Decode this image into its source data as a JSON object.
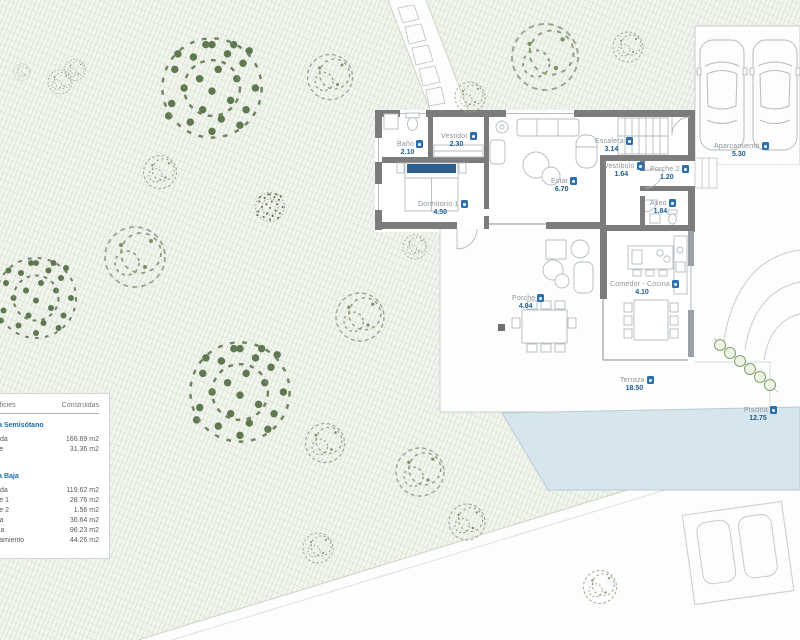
{
  "legend": {
    "header": {
      "col1": "Superficies",
      "col2": "Construidas"
    },
    "sections": [
      {
        "title": "Planta Semisótano",
        "rows": [
          {
            "label": "Vivienda",
            "value": "166.69 m2"
          },
          {
            "label": "Porche",
            "value": "31.36 m2"
          }
        ]
      },
      {
        "title": "Planta Baja",
        "rows": [
          {
            "label": "Vivienda",
            "value": "119.62 m2"
          },
          {
            "label": "Porche 1",
            "value": "28.76 m2"
          },
          {
            "label": "Porche 2",
            "value": "1.56 m2"
          },
          {
            "label": "Piscina",
            "value": "36.64 m2"
          },
          {
            "label": "Terraza",
            "value": "96.23 m2"
          },
          {
            "label": "Aparcamiento",
            "value": "44.26 m2"
          }
        ]
      }
    ]
  },
  "rooms": [
    {
      "label": "Baño",
      "value": "2.10"
    },
    {
      "label": "Vestidor",
      "value": "2.30"
    },
    {
      "label": "Dormitorio 1",
      "value": "4.50"
    },
    {
      "label": "Estar",
      "value": "6.70"
    },
    {
      "label": "Escalera",
      "value": "3.14"
    },
    {
      "label": "Vestíbulo",
      "value": "1.64"
    },
    {
      "label": "Porche 2",
      "value": "1.20"
    },
    {
      "label": "Aseo",
      "value": "1.84"
    },
    {
      "label": "Comedor - Cocina",
      "value": "4.10"
    },
    {
      "label": "Porche",
      "value": "4.04"
    },
    {
      "label": "Terraza",
      "value": "18.50"
    },
    {
      "label": "Piscina",
      "value": "12.75"
    },
    {
      "label": "Aparcamiento",
      "value": "5.30"
    }
  ],
  "colors": {
    "marker_blue": "#2a6fae",
    "value_blue": "#1d5e93",
    "wall_gray": "#7c7c7c",
    "pool_blue": "#d7e6ec",
    "bed_blue": "#2e5e8e",
    "garden_tint": "#f2f5ee"
  }
}
